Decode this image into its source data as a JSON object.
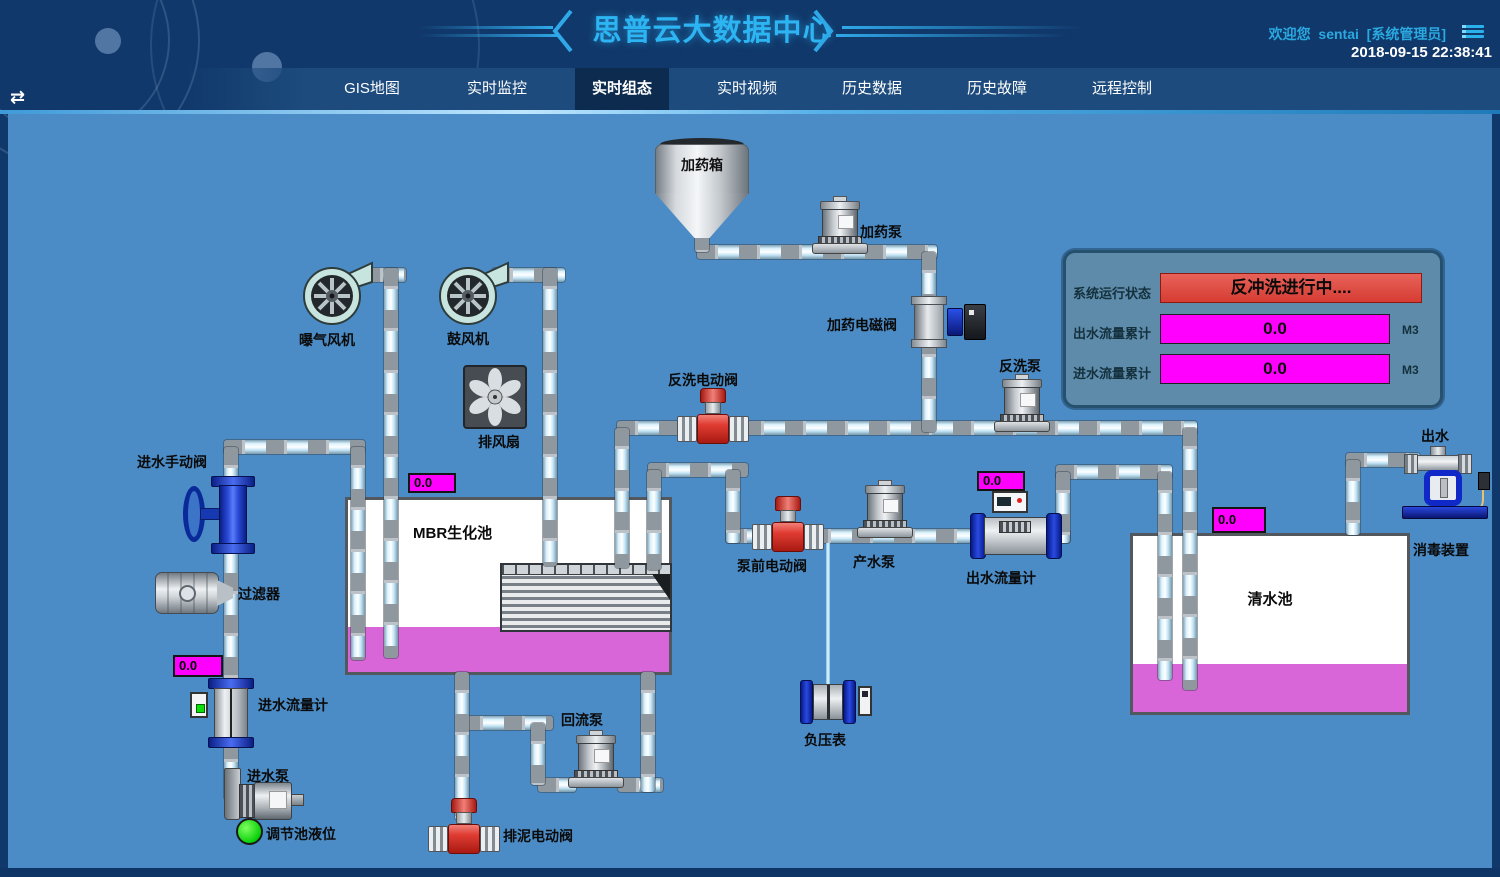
{
  "app": {
    "title": "思普云大数据中心",
    "welcome_prefix": "欢迎您",
    "username": "sentai",
    "role": "[系统管理员]",
    "datetime": "2018-09-15 22:38:41"
  },
  "nav": {
    "tabs": [
      {
        "label": "GIS地图",
        "active": false
      },
      {
        "label": "实时监控",
        "active": false
      },
      {
        "label": "实时组态",
        "active": true
      },
      {
        "label": "实时视频",
        "active": false
      },
      {
        "label": "历史数据",
        "active": false
      },
      {
        "label": "历史故障",
        "active": false
      },
      {
        "label": "远程控制",
        "active": false
      }
    ]
  },
  "status_panel": {
    "system_status_label": "系统运行状态",
    "system_status_value": "反冲洗进行中....",
    "outflow_label": "出水流量累计",
    "outflow_value": "0.0",
    "outflow_unit": "M3",
    "inflow_label": "进水流量累计",
    "inflow_value": "0.0",
    "inflow_unit": "M3"
  },
  "meters": {
    "inlet_flow": "0.0",
    "mbr_level": "0.0",
    "outlet_flow": "0.0",
    "clean_tank_level": "0.0"
  },
  "labels": {
    "dosing_tank": "加药箱",
    "dosing_pump": "加药泵",
    "dosing_solenoid_valve": "加药电磁阀",
    "backwash_valve": "反洗电动阀",
    "backwash_pump": "反洗泵",
    "aeration_blower": "曝气风机",
    "blower": "鼓风机",
    "exhaust_fan": "排风扇",
    "inlet_manual_valve": "进水手动阀",
    "filter": "过滤器",
    "inlet_flow_meter": "进水流量计",
    "inlet_pump": "进水泵",
    "regulating_tank_level": "调节池液位",
    "mbr_tank": "MBR生化池",
    "prepump_valve": "泵前电动阀",
    "product_pump": "产水泵",
    "outlet_flow_meter": "出水流量计",
    "return_pump": "回流泵",
    "sludge_valve": "排泥电动阀",
    "vacuum_gauge": "负压表",
    "clean_tank": "清水池",
    "outlet": "出水",
    "disinfection": "消毒装置"
  },
  "colors": {
    "accent_cyan": "#2db4f2",
    "alarm_red": "#e0443c",
    "meter_magenta": "#ff00ff",
    "liquid_magenta": "#d966d9",
    "diagram_blue": "#4b8cc6"
  }
}
